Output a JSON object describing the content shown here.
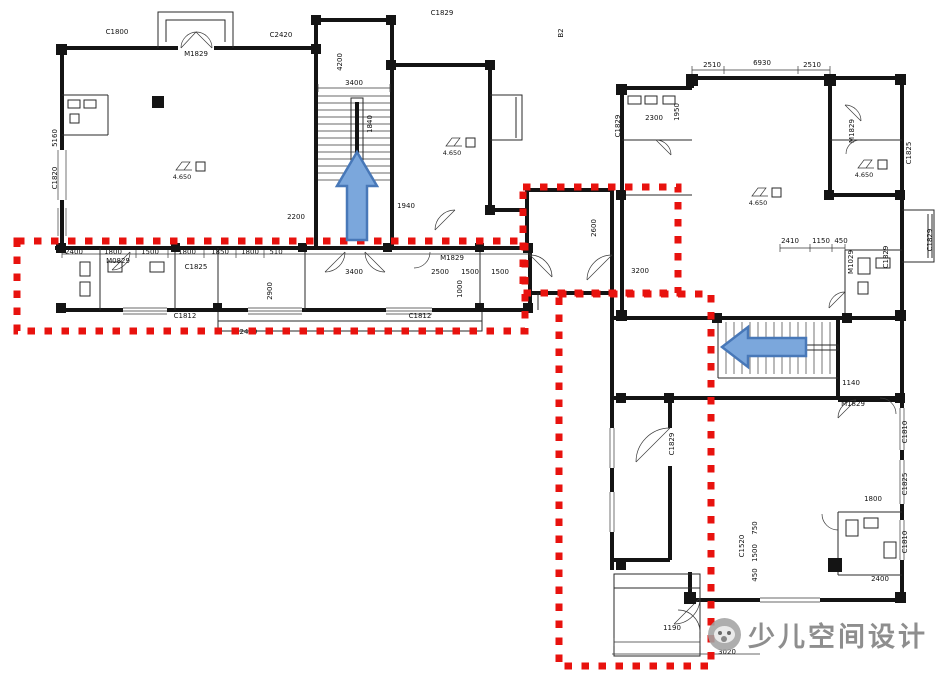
{
  "watermark": {
    "text": "少儿空间设计",
    "logo_icon": "brand-circle-logo",
    "color": "#8e8e8e"
  },
  "annotations": {
    "highlight_color": "#e8120e",
    "zones": [
      {
        "id": "zone-left-corridor",
        "x": 17,
        "y": 241,
        "w": 508,
        "h": 90
      },
      {
        "id": "zone-connector",
        "x": 523,
        "y": 187,
        "w": 155,
        "h": 106
      },
      {
        "id": "zone-lower-right",
        "x": 559,
        "y": 294,
        "w": 152,
        "h": 372
      }
    ],
    "arrows": {
      "fill": "#7ba7dc",
      "stroke": "#4878b8",
      "items": [
        {
          "id": "up-arrow-left-stair",
          "dir": "up",
          "points": "357,152 377,186 367,186 367,240 347,240 347,186 337,186"
        },
        {
          "id": "left-arrow-right-stair",
          "dir": "left",
          "points": "722,347 748,327 748,338 806,338 806,356 748,356 748,367"
        }
      ]
    }
  },
  "plan": {
    "wall_color": "#141414",
    "elevation_value": "4.650",
    "elevation_marks": [
      {
        "x": 176,
        "y": 170
      },
      {
        "x": 446,
        "y": 146
      },
      {
        "x": 752,
        "y": 196
      },
      {
        "x": 858,
        "y": 168
      }
    ],
    "labels": [
      {
        "t": "C1800",
        "x": 117,
        "y": 34
      },
      {
        "t": "M1829",
        "x": 196,
        "y": 56
      },
      {
        "t": "C2420",
        "x": 281,
        "y": 37
      },
      {
        "t": "C1829",
        "x": 442,
        "y": 15
      },
      {
        "t": "B2",
        "x": 563,
        "y": 33,
        "r": -90
      },
      {
        "t": "3400",
        "x": 354,
        "y": 85
      },
      {
        "t": "4200",
        "x": 342,
        "y": 62,
        "r": -90
      },
      {
        "t": "1840",
        "x": 372,
        "y": 124,
        "r": -90
      },
      {
        "t": "C1820",
        "x": 57,
        "y": 178,
        "r": -90
      },
      {
        "t": "5160",
        "x": 57,
        "y": 138,
        "r": -90
      },
      {
        "t": "2200",
        "x": 296,
        "y": 219
      },
      {
        "t": "1940",
        "x": 406,
        "y": 208
      },
      {
        "t": "2400",
        "x": 74,
        "y": 254
      },
      {
        "t": "1800",
        "x": 113,
        "y": 254
      },
      {
        "t": "1500",
        "x": 150,
        "y": 254
      },
      {
        "t": "1800",
        "x": 187,
        "y": 254
      },
      {
        "t": "1850",
        "x": 220,
        "y": 254
      },
      {
        "t": "1800",
        "x": 250,
        "y": 254
      },
      {
        "t": "510",
        "x": 276,
        "y": 254
      },
      {
        "t": "M0829",
        "x": 118,
        "y": 263
      },
      {
        "t": "C1825",
        "x": 196,
        "y": 269
      },
      {
        "t": "3400",
        "x": 354,
        "y": 274
      },
      {
        "t": "2500",
        "x": 440,
        "y": 274
      },
      {
        "t": "M1829",
        "x": 452,
        "y": 260
      },
      {
        "t": "1500",
        "x": 470,
        "y": 274
      },
      {
        "t": "1500",
        "x": 500,
        "y": 274
      },
      {
        "t": "1000",
        "x": 462,
        "y": 289,
        "r": -90
      },
      {
        "t": "2900",
        "x": 272,
        "y": 291,
        "r": -90
      },
      {
        "t": "C1812",
        "x": 185,
        "y": 318
      },
      {
        "t": "C1812",
        "x": 420,
        "y": 318
      },
      {
        "t": "C2420",
        "x": 246,
        "y": 334
      },
      {
        "t": "2600",
        "x": 596,
        "y": 228,
        "r": -90
      },
      {
        "t": "3200",
        "x": 640,
        "y": 273
      },
      {
        "t": "2510",
        "x": 712,
        "y": 67
      },
      {
        "t": "6930",
        "x": 762,
        "y": 65
      },
      {
        "t": "2510",
        "x": 812,
        "y": 67
      },
      {
        "t": "2300",
        "x": 654,
        "y": 120
      },
      {
        "t": "1950",
        "x": 679,
        "y": 112,
        "r": -90
      },
      {
        "t": "C1829",
        "x": 620,
        "y": 126,
        "r": -90
      },
      {
        "t": "M1829",
        "x": 854,
        "y": 131,
        "r": -90
      },
      {
        "t": "C1825",
        "x": 911,
        "y": 153,
        "r": -90
      },
      {
        "t": "2410",
        "x": 790,
        "y": 243
      },
      {
        "t": "1150",
        "x": 821,
        "y": 243
      },
      {
        "t": "450",
        "x": 841,
        "y": 243
      },
      {
        "t": "M1029",
        "x": 853,
        "y": 262,
        "r": -90
      },
      {
        "t": "C1829",
        "x": 888,
        "y": 257,
        "r": -90
      },
      {
        "t": "C1829",
        "x": 932,
        "y": 240,
        "r": -90
      },
      {
        "t": "1140",
        "x": 851,
        "y": 385
      },
      {
        "t": "M1829",
        "x": 853,
        "y": 406
      },
      {
        "t": "C1810",
        "x": 907,
        "y": 432,
        "r": -90
      },
      {
        "t": "C1825",
        "x": 907,
        "y": 484,
        "r": -90
      },
      {
        "t": "C1810",
        "x": 907,
        "y": 542,
        "r": -90
      },
      {
        "t": "1800",
        "x": 873,
        "y": 501
      },
      {
        "t": "2400",
        "x": 880,
        "y": 581
      },
      {
        "t": "C1520",
        "x": 744,
        "y": 546,
        "r": -90
      },
      {
        "t": "750",
        "x": 757,
        "y": 528,
        "r": -90
      },
      {
        "t": "1500",
        "x": 757,
        "y": 553,
        "r": -90
      },
      {
        "t": "450",
        "x": 757,
        "y": 575,
        "r": -90
      },
      {
        "t": "C1829",
        "x": 674,
        "y": 444,
        "r": -90
      },
      {
        "t": "1190",
        "x": 672,
        "y": 630
      },
      {
        "t": "3020",
        "x": 727,
        "y": 654
      }
    ]
  }
}
